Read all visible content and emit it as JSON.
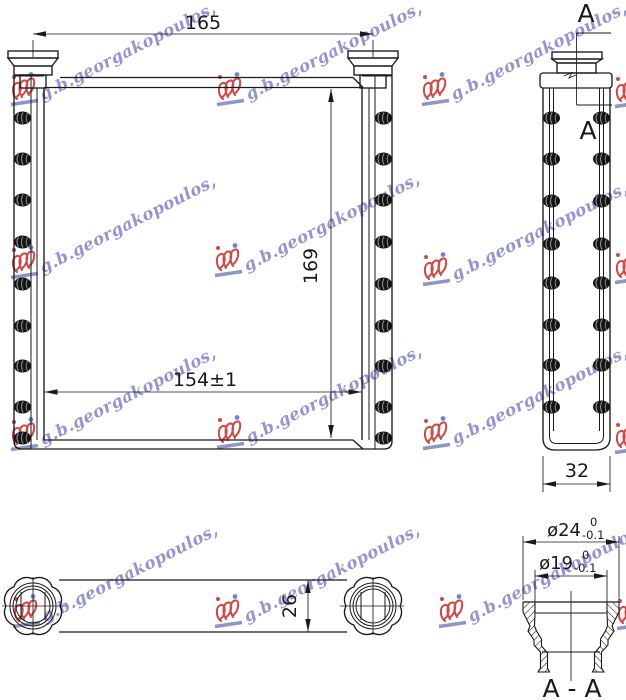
{
  "watermark": {
    "text": "g.b.georgakopoulos,",
    "text_color": "#6a6abe",
    "logo_color": "#c43431",
    "underline_color": "#7d88c0",
    "dot_color": "#5b74c9"
  },
  "front_view": {
    "width_overall": "165",
    "height_core": "169",
    "width_core": "154±1"
  },
  "side_view": {
    "depth": "32",
    "section_marker_top": "A",
    "section_marker_bottom": "A"
  },
  "bottom_view": {
    "thickness": "26"
  },
  "section_view": {
    "label": "A - A",
    "outer_dia": "ø24",
    "outer_dia_tol_upper": "0",
    "outer_dia_tol_lower": "-0.1",
    "inner_dia": "ø19",
    "inner_dia_tol_upper": "0",
    "inner_dia_tol_lower": "-0.1"
  },
  "line_color": "#1a1a1a"
}
